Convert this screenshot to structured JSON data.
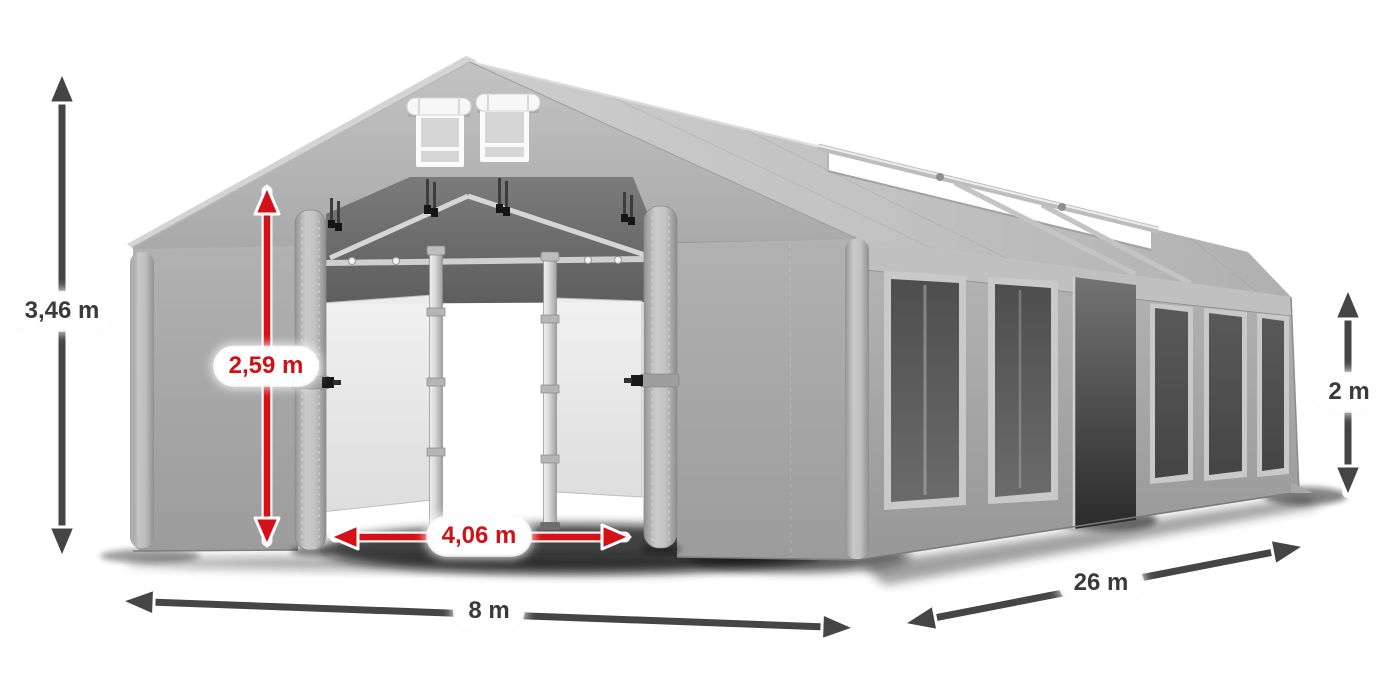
{
  "colors": {
    "arrow_dark": "#454545",
    "arrow_red": "#d31117",
    "label_dark": "#3a3a3a",
    "label_red": "#d01116",
    "pill_background": "#ffffff"
  },
  "dimensions": {
    "total_height": {
      "label": "3,46 m"
    },
    "door_height": {
      "label": "2,59 m"
    },
    "door_width": {
      "label": "4,06 m"
    },
    "width": {
      "label": "8 m"
    },
    "length": {
      "label": "26 m"
    },
    "side_height": {
      "label": "2 m"
    }
  }
}
